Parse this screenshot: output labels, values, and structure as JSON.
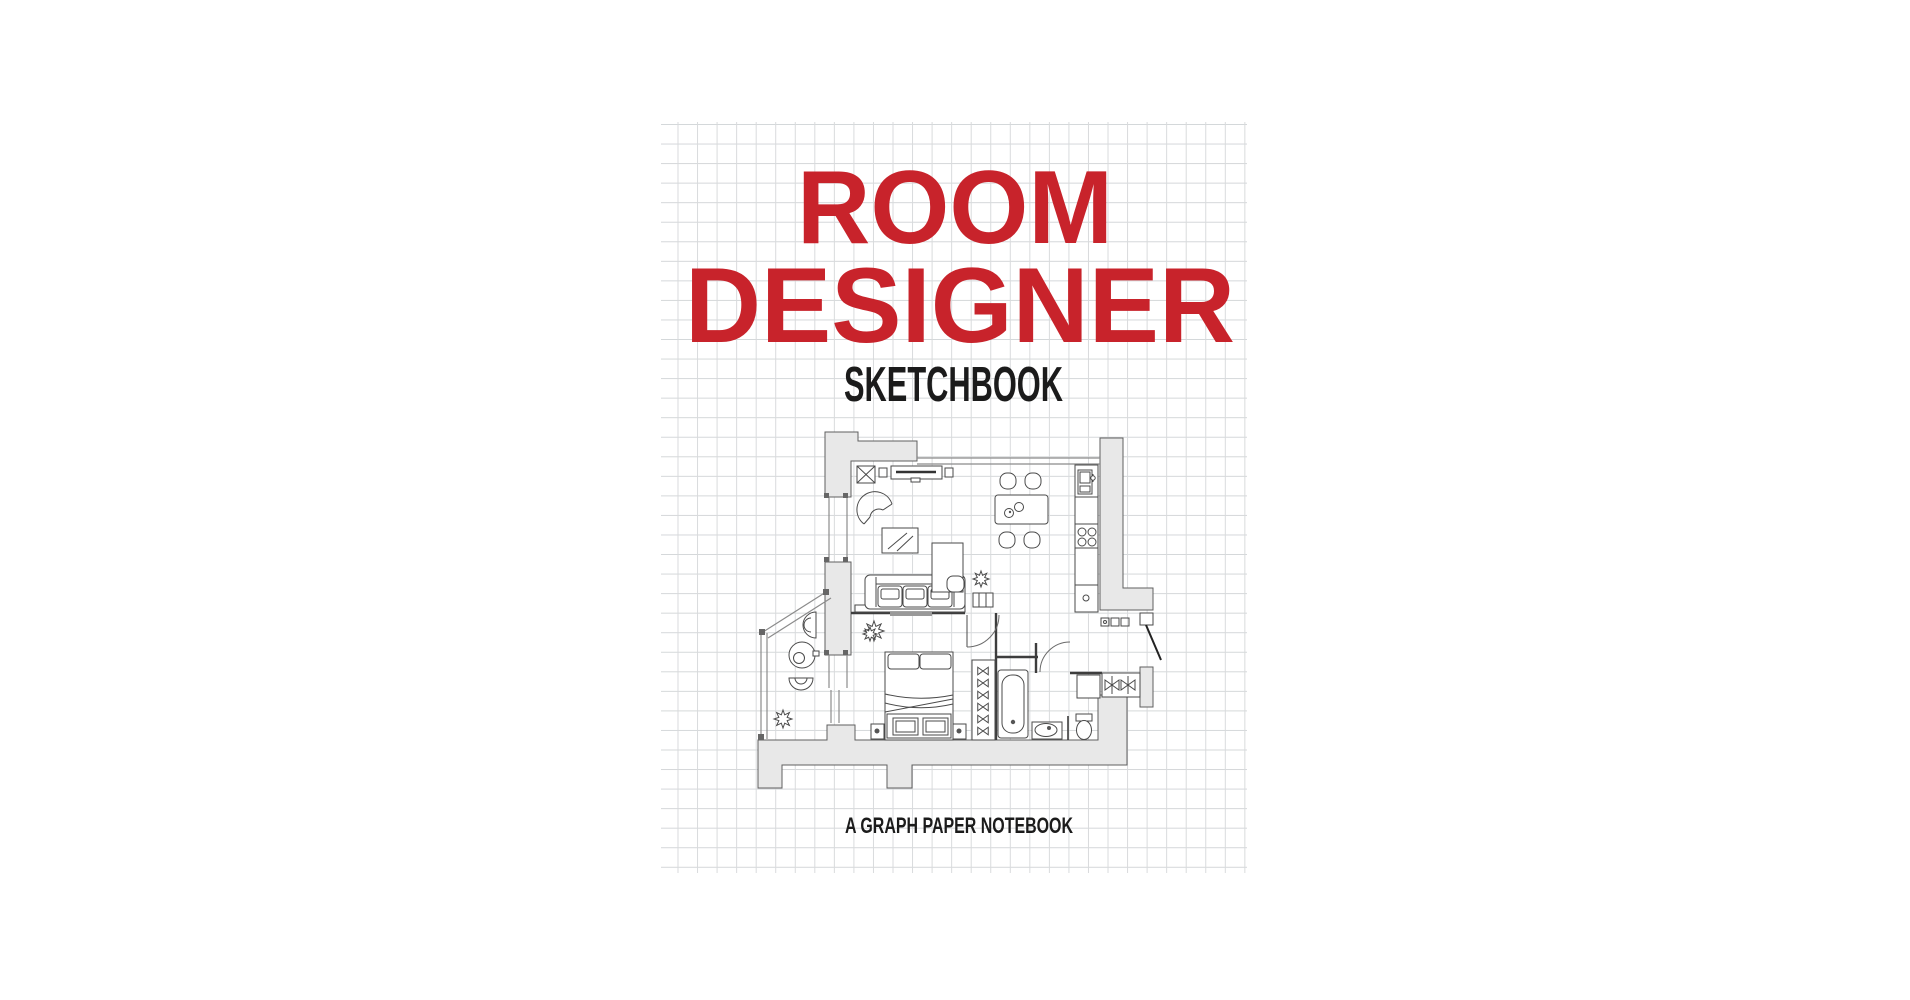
{
  "page": {
    "background": "#ffffff",
    "description": "Book cover on white page: graph paper notebook product cover"
  },
  "cover": {
    "title_line1": "ROOM",
    "title_line2": "DESIGNER",
    "subtitle": "SKETCHBOOK",
    "tagline": "A GRAPH PAPER NOTEBOOK",
    "colors": {
      "title_red": "#c8232b",
      "text_black": "#1b1b1b",
      "grid_line": "#d8dadc",
      "wall_fill": "#e8e8e8",
      "plan_line": "#4a4a4a"
    },
    "illustration": {
      "name": "apartment-floor-plan",
      "rooms": [
        "living-room",
        "kitchen-dining",
        "bedroom",
        "bathroom",
        "toilet-room",
        "entry-hall"
      ],
      "furniture": [
        "tv-console",
        "armchair",
        "coffee-table",
        "desk",
        "sofa",
        "plants",
        "dining-table",
        "chairs",
        "kitchen-counter",
        "sink",
        "stove",
        "bed",
        "nightstands",
        "drying-rack",
        "bathtub",
        "washbasin",
        "toilet",
        "bidet",
        "wardrobe",
        "entry-door"
      ]
    }
  }
}
